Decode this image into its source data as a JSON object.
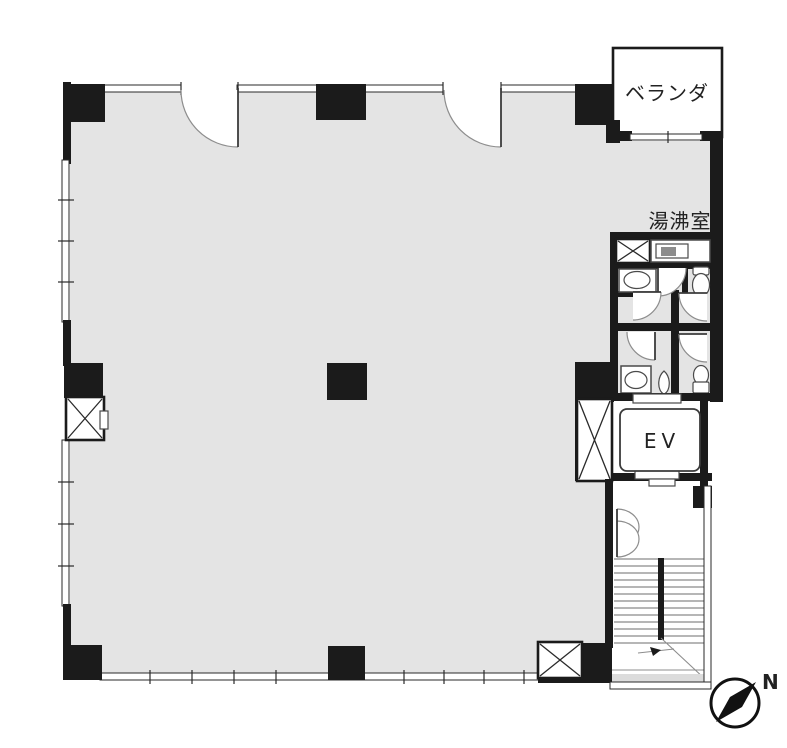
{
  "plan": {
    "labels": {
      "veranda": "ベランダ",
      "hot_water_room": "湯沸室",
      "elevator": "EV",
      "compass_north": "N"
    },
    "colors": {
      "floor": "#e4e4e4",
      "wall": "#1b1b1b",
      "background": "#ffffff",
      "stair_shade": "#dcdcdc"
    }
  }
}
